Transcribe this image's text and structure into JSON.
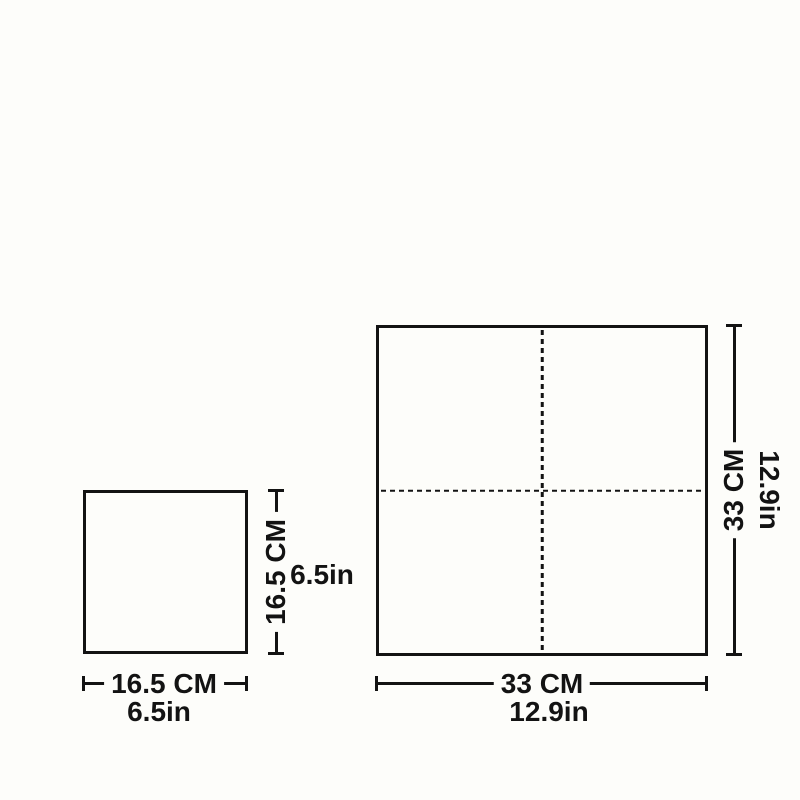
{
  "diagram": {
    "colors": {
      "ink": "#131313",
      "background": "#fdfdfa"
    },
    "small_square": {
      "height_cm": "16.5 CM",
      "height_in": "6.5in",
      "width_cm": "16.5 CM",
      "width_in": "6.5in"
    },
    "large_square": {
      "height_cm": "33 CM",
      "height_in": "12.9in",
      "width_cm": "33 CM",
      "width_in": "12.9in"
    }
  }
}
